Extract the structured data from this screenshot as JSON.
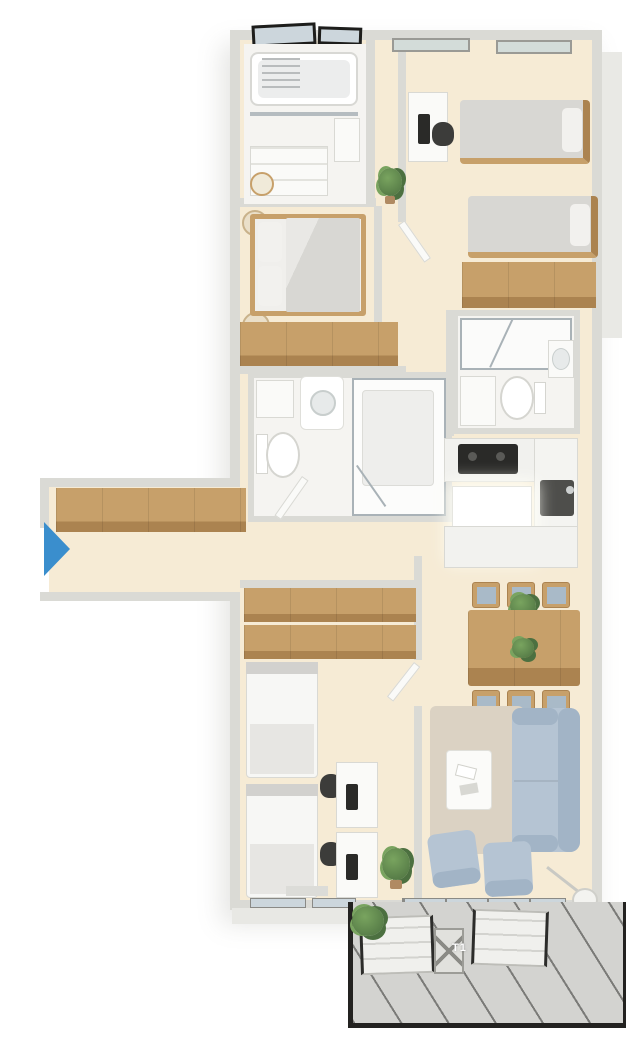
{
  "palette": {
    "wall": "#dadad5",
    "floor": "#f6ebd5",
    "tile": "#f5f4f1",
    "wood": "#c7a06a",
    "wood_dark": "#ab8350",
    "white": "#fafaf8",
    "line": "#d9d9d4",
    "black": "#2a2a28",
    "gray": "#3c3c3a",
    "bed_gray": "#d8d7d3",
    "pillow": "#f2f1ee",
    "sofa": "#b5c4d3",
    "sofa_dark": "#a2b4c6",
    "rug": "#dbd2c3",
    "glass": "#ccd6dc",
    "frame": "#1d1d1b",
    "arrow": "#3a8ecd",
    "plant_dark": "#4c7040",
    "plant_light": "#79a45f",
    "balcony_floor": "#d3d3d0",
    "balcony_line": "#4a4a46"
  },
  "labels": {
    "balcony_glass": "T1"
  },
  "entry": {
    "marker": "entry-arrow",
    "direction": "right",
    "color": "#3a8ecd"
  },
  "rooms": [
    {
      "name": "bathroom-top",
      "furniture": [
        "bathtub",
        "glass-screen",
        "vanity-cabinet",
        "side-cabinet",
        "stool"
      ]
    },
    {
      "name": "bedroom-top-right",
      "furniture": [
        "desk",
        "office-chair",
        "single-bed",
        "single-bed",
        "wardrobe"
      ]
    },
    {
      "name": "master-bedroom",
      "furniture": [
        "double-bed",
        "nightstand",
        "nightstand",
        "sideboard-wardrobe",
        "plant"
      ]
    },
    {
      "name": "bathroom-middle",
      "furniture": [
        "cabinet",
        "washbasin",
        "toilet",
        "walk-in-shower",
        "door"
      ]
    },
    {
      "name": "bathroom-right",
      "furniture": [
        "shower",
        "toilet",
        "washbasin",
        "cabinet"
      ]
    },
    {
      "name": "kitchen",
      "furniture": [
        "counter",
        "cooktop",
        "tall-cabinet",
        "sink",
        "island",
        "peninsula"
      ]
    },
    {
      "name": "entry-hall",
      "furniture": [
        "wardrobe",
        "entry-arrow"
      ]
    },
    {
      "name": "bedroom-bottom-left",
      "furniture": [
        "wardrobe",
        "wardrobe",
        "single-bed",
        "single-bed",
        "desk",
        "desk",
        "office-chair",
        "office-chair",
        "shelf",
        "plant"
      ]
    },
    {
      "name": "living-dining",
      "furniture": [
        "dining-table",
        "dining-chair",
        "dining-chair",
        "dining-chair",
        "dining-chair",
        "dining-chair",
        "dining-chair",
        "table-plant",
        "rug",
        "coffee-table",
        "books",
        "sofa",
        "armchair",
        "armchair",
        "floor-lamp"
      ]
    },
    {
      "name": "balcony",
      "furniture": [
        "lounge-chair",
        "lounge-chair",
        "folding-chair",
        "hanging-plant"
      ]
    }
  ]
}
